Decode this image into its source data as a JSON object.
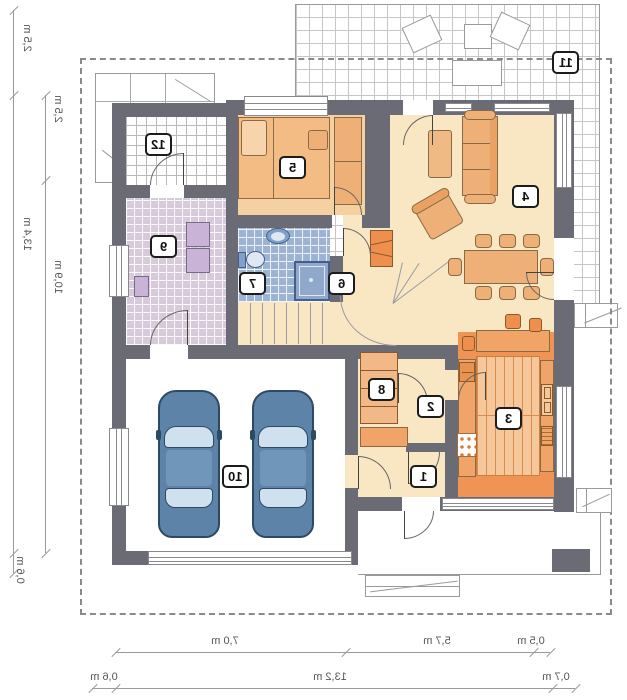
{
  "plan": {
    "type": "floor-plan",
    "mirrored": true,
    "rooms": [
      {
        "id": "1"
      },
      {
        "id": "2"
      },
      {
        "id": "3"
      },
      {
        "id": "4"
      },
      {
        "id": "5"
      },
      {
        "id": "6"
      },
      {
        "id": "7"
      },
      {
        "id": "8"
      },
      {
        "id": "9"
      },
      {
        "id": "10"
      },
      {
        "id": "11"
      },
      {
        "id": "12"
      }
    ],
    "dimensions": {
      "left_outer": [
        "2,5 m",
        "13,4 m",
        "0,6 m"
      ],
      "left_inner": [
        "2,5 m",
        "10,9 m"
      ],
      "bottom_upper": [
        "7,0 m",
        "5,7 m",
        "0,5 m"
      ],
      "bottom_lower": [
        "0,6 m",
        "13,2 m",
        "0,7 m"
      ]
    }
  },
  "colors": {
    "wall": "#6b6b75",
    "floor_cream": "#f9e7c3",
    "floor_bedroom": "#f5d1a1",
    "floor_kitchen": "#ef9455",
    "kitchen_planks": "#f6c79b",
    "floor_bath": "#9db3d3",
    "floor_utility": "#d7cadb",
    "furniture_orange": "#eeb077",
    "accent_orange": "#ee8f4d",
    "car_blue": "#5d83a8",
    "car_window": "#cfe0ee",
    "appliance_purple": "#c9b3d6",
    "dim_line": "#9a9a9a",
    "dashed_boundary": "#8a8a8a"
  }
}
